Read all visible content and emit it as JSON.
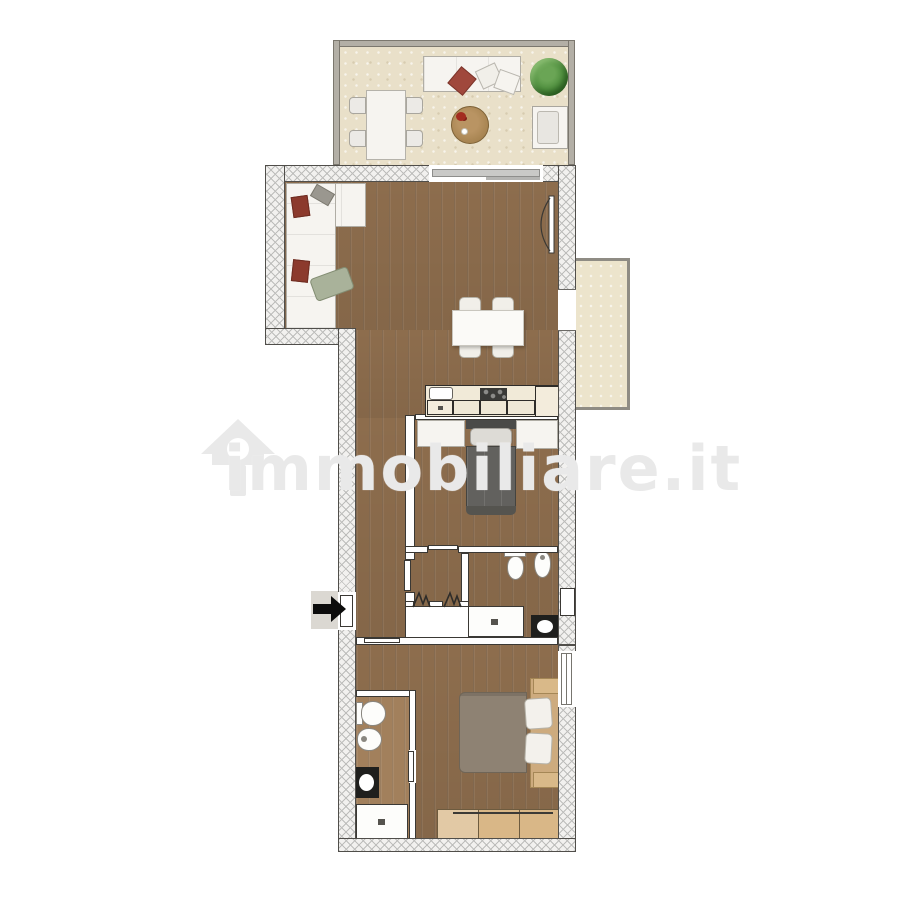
{
  "watermark": {
    "text": "immobiliare.it",
    "icon": "house-outline-icon"
  },
  "entrance": {
    "arrow_direction": "right"
  },
  "palette": {
    "background": "#ffffff",
    "wood_floor": "#8d6d4d",
    "bathroom2_floor": "#a2805c",
    "terrace_floor": "#e9e0c9",
    "balcony_floor": "#ece4cc",
    "wall_hatch_line": "#bdbdbb",
    "wall_outline": "#3a3834",
    "terrace_wall": "#b3afa6",
    "sofa_white": "#f6f4f0",
    "pillow_red": "#8c3a2d",
    "throw_green": "#a9b29a",
    "plant_green": "#4f8f3e",
    "round_table_wood": "#a5824f",
    "bed1_blanket": "#62615e",
    "bed2_blanket": "#8e8273",
    "wardrobe_wood": "#d9b787",
    "vanity_dark": "#1f1f1d",
    "entry_arrow": "#0c0c0c",
    "watermark_gray": "#e9e9e9"
  },
  "diagram_data": {
    "type": "floor-plan",
    "entrance": "left-side-arrow",
    "rooms": [
      {
        "id": "terrace",
        "position": "top",
        "furniture": [
          "outdoor-sofa",
          "decorative-plant",
          "round-coffee-table",
          "outdoor-dining-table",
          "outdoor-chair x4",
          "outdoor-armchair"
        ]
      },
      {
        "id": "living-room",
        "position": "upper-middle",
        "furniture": [
          "corner-sofa",
          "dining-table",
          "dining-chair x4"
        ],
        "openings": [
          "sliding-glass-door-to-terrace",
          "door-upper-right",
          "opening-to-balcony"
        ]
      },
      {
        "id": "kitchen-corner",
        "position": "middle",
        "furniture": [
          "kitchen-sink",
          "cooktop-4-burners",
          "base-cabinet x3",
          "tall-cabinet"
        ]
      },
      {
        "id": "balcony",
        "position": "right",
        "furniture": []
      },
      {
        "id": "bedroom-1",
        "position": "middle",
        "furniture": [
          "single-bed",
          "storage-unit-left",
          "storage-unit-right"
        ]
      },
      {
        "id": "hallway",
        "position": "left-middle",
        "furniture": [
          "built-in-closet-with-bifold-doors"
        ]
      },
      {
        "id": "bathroom-1",
        "position": "middle-right",
        "furniture": [
          "toilet",
          "bidet",
          "shower-tray",
          "washbasin-cabinet"
        ]
      },
      {
        "id": "bedroom-2",
        "position": "bottom",
        "furniture": [
          "double-bed",
          "nightstand x2",
          "wardrobe"
        ]
      },
      {
        "id": "bathroom-2",
        "position": "bottom-left",
        "furniture": [
          "toilet",
          "bidet",
          "washbasin-cabinet",
          "shower-tray"
        ]
      }
    ]
  }
}
